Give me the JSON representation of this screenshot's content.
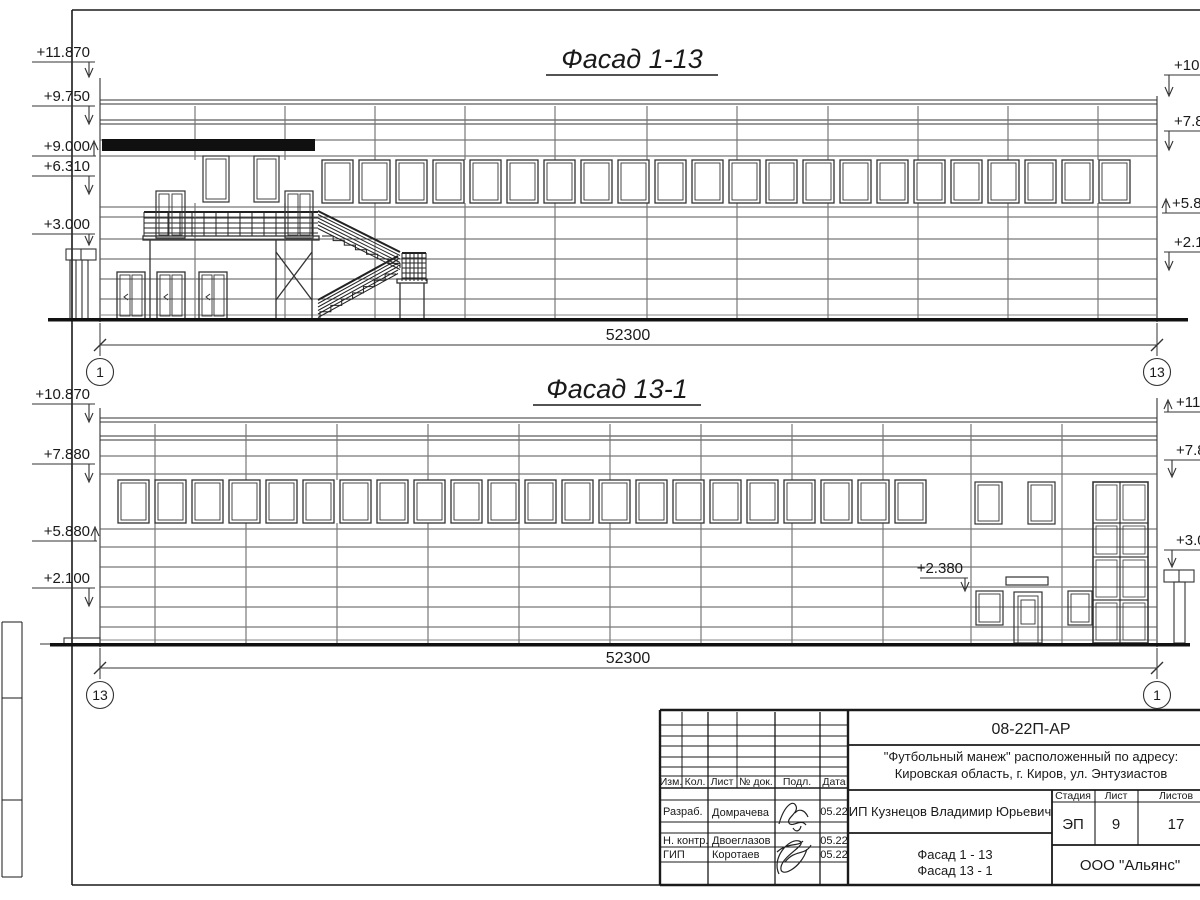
{
  "sheet": {
    "facade1": {
      "title": "Фасад 1-13",
      "dimension": "52300",
      "axis_left": "1",
      "axis_right": "13",
      "marks_left": [
        "+11.870",
        "+9.750",
        "+9.000",
        "+6.310",
        "+3.000"
      ],
      "marks_right": [
        "+10.8",
        "+7.8",
        "+5.8",
        "+2.1"
      ]
    },
    "facade2": {
      "title": "Фасад 13-1",
      "dimension": "52300",
      "axis_left": "13",
      "axis_right": "1",
      "marks_left": [
        "+10.870",
        "+7.880",
        "+5.880",
        "+2.100"
      ],
      "marks_right": [
        "+11.8",
        "+7.8",
        "+3.0"
      ],
      "mark_inner": "+2.380"
    },
    "titleblock": {
      "doc_number": "08-22П-АР",
      "project_line1": "\"Футбольный манеж\" расположенный по адресу:",
      "project_line2": "Кировская область, г. Киров, ул. Энтузиастов",
      "client": "ИП Кузнецов Владимир Юрьевич",
      "columns": [
        "Изм.",
        "Кол.",
        "Лист",
        "№ док.",
        "Подл.",
        "Дата"
      ],
      "rows": [
        {
          "role": "Разраб.",
          "name": "Домрачева",
          "date": "05.22"
        },
        {
          "role": "Н. контр.",
          "name": "Двоеглазов",
          "date": "05.22"
        },
        {
          "role": "ГИП",
          "name": "Коротаев",
          "date": "05.22"
        }
      ],
      "stage_label": "Стадия",
      "sheet_label": "Лист",
      "sheets_label": "Листов",
      "stage": "ЭП",
      "sheet": "9",
      "sheets": "17",
      "drawing_line1": "Фасад 1 - 13",
      "drawing_line2": "Фасад 13 - 1",
      "company": "ООО \"Альянс\""
    }
  }
}
